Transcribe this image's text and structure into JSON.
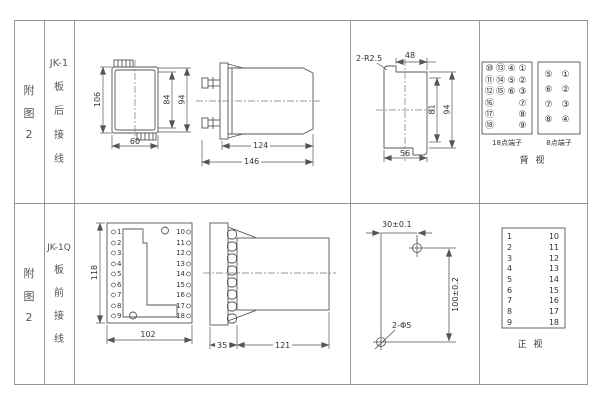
{
  "sidebar": {
    "r1_fig": [
      "附",
      "图",
      "2"
    ],
    "r1_model": "JK-1",
    "r1_wiring": [
      "板",
      "后",
      "接",
      "线"
    ],
    "r2_fig": [
      "附",
      "图",
      "2"
    ],
    "r2_model": "JK-1Q",
    "r2_wiring": [
      "板",
      "前",
      "接",
      "线"
    ]
  },
  "jk1": {
    "front": {
      "dim_height": "106",
      "dim_inner": "84",
      "dim_right": "94",
      "dim_width": "60"
    },
    "side": {
      "dim_body": "124",
      "dim_total": "146"
    },
    "cutout": {
      "callout": "2-R2.5",
      "dim_top": "48",
      "dim_inner": "81",
      "dim_right": "94",
      "dim_bottom": "56"
    },
    "term18": {
      "label": "18点端子",
      "r0": [
        "⑩",
        "⑬",
        "④",
        "①"
      ],
      "r1": [
        "⑪",
        "⑭",
        "⑤",
        "②"
      ],
      "r2": [
        "⑫",
        "⑮",
        "⑥",
        "③"
      ],
      "left": [
        "⑯",
        "⑰",
        "⑱"
      ],
      "right": [
        "⑦",
        "⑧",
        "⑨"
      ]
    },
    "term8": {
      "label": "8点端子",
      "rows": [
        [
          "⑤",
          "①"
        ],
        [
          "⑥",
          "②"
        ],
        [
          "⑦",
          "③"
        ],
        [
          "⑧",
          "④"
        ]
      ]
    },
    "view_label": "背 视"
  },
  "jk1q": {
    "front": {
      "dim_height": "118",
      "dim_width": "102",
      "pins_left": [
        "1",
        "2",
        "3",
        "4",
        "5",
        "6",
        "7",
        "8",
        "9"
      ],
      "pins_right": [
        "10",
        "11",
        "12",
        "13",
        "14",
        "15",
        "16",
        "17",
        "18"
      ]
    },
    "side": {
      "dim_flange": "35",
      "dim_body": "121"
    },
    "drill": {
      "dim_x": "30±0.1",
      "dim_y": "100±0.2",
      "callout": "2-Φ5"
    },
    "table": {
      "left": [
        "1",
        "2",
        "3",
        "4",
        "5",
        "6",
        "7",
        "8",
        "9"
      ],
      "right": [
        "10",
        "11",
        "12",
        "13",
        "14",
        "15",
        "16",
        "17",
        "18"
      ]
    },
    "view_label": "正 视"
  }
}
